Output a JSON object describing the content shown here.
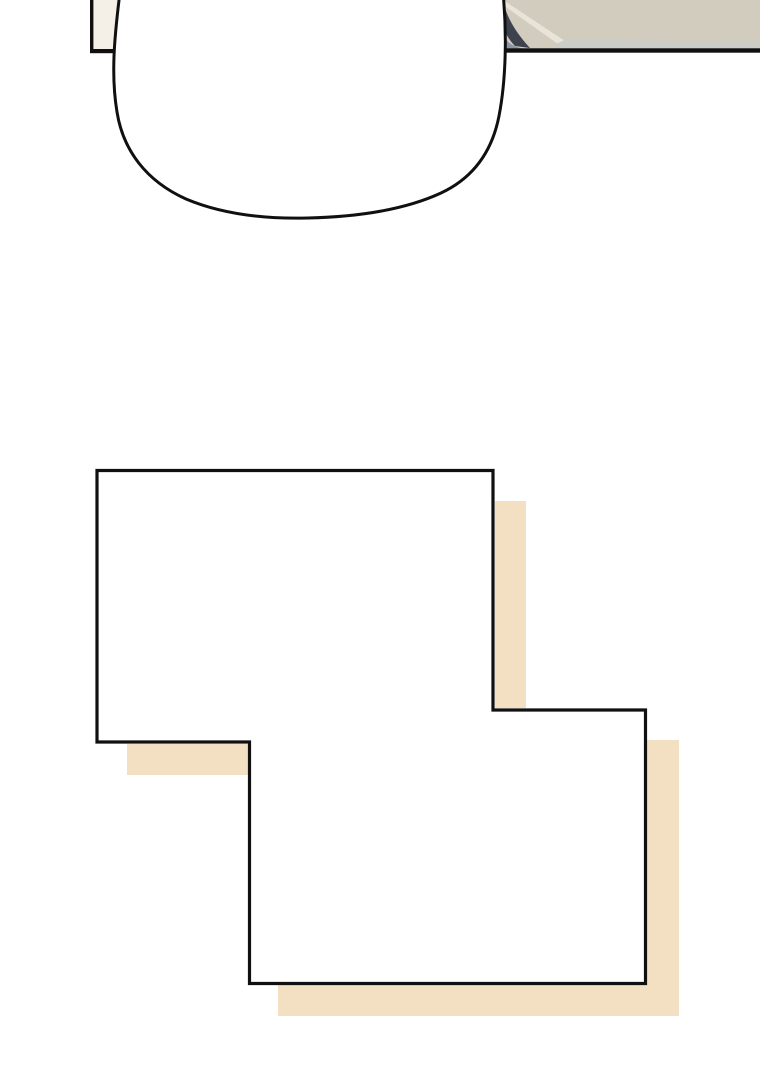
{
  "scene": {
    "description_role": "webtoon-comic-page-fragment",
    "speech_bubble_text": ""
  },
  "colors": {
    "background": "#ffffff",
    "ink": "#101010",
    "panel_fill": "#ffffff",
    "bubble_fill": "#ffffff",
    "cream_wall": "#f4efe7",
    "desk_surface": "#d2ccbe",
    "desk_highlight": "#e8e4d7",
    "desk_edge_strip": "#cbcdc8",
    "sleeve_dark": "#3e424c",
    "sleeve_light": "#8c95a6",
    "shadow_beige": "#f3e0c3"
  }
}
